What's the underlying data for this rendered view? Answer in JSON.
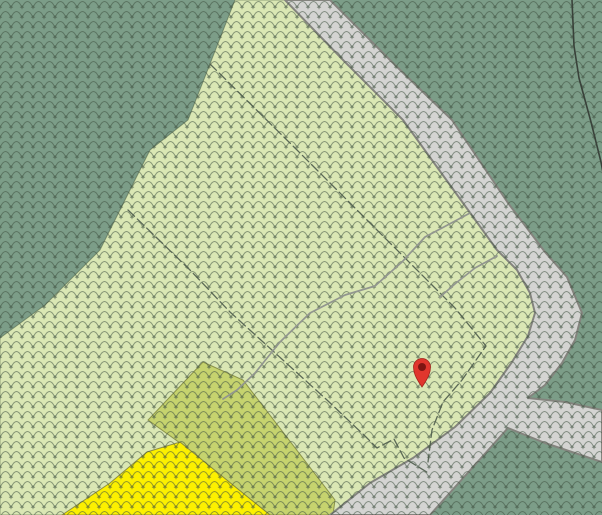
{
  "map": {
    "description": "forest-cadastral-map-with-location-marker",
    "canvas": {
      "width": 602,
      "height": 515
    },
    "colors": {
      "forest_dark_green": "#7C9D88",
      "forest_light_green": "#DAE7B4",
      "meadow_olive": "#C6D36E",
      "meadow_yellow": "#FCF000",
      "road_fill": "#D4D4D2",
      "road_casing": "#84847E",
      "parcel_line": "#4E5C4B",
      "path_line": "#92968F",
      "contour_line": "#39423A",
      "pattern_stroke": "#3F5142",
      "region_edge": "rgba(70,90,60,0.5)",
      "olive_edge": "rgba(110,115,45,0.7)",
      "yellow_edge": "rgba(120,120,60,0.8)",
      "marker_red": "#E0362D",
      "marker_dark_red": "#7E1512",
      "marker_outline": "#A3221B"
    },
    "forest_pattern": {
      "tile_width": 11,
      "tile_height": 10,
      "opacity": 0.55,
      "arc_path": "M0,7.5 Q5.5,-4.5 11,7.5",
      "tree_plus_path": "M0,5.2 L0,9.3 M-2.1,7.2 L2.1,7.2 M11,5.2 L11,9.3 M8.9,7.2 L13.1,7.2"
    },
    "regions": [
      {
        "name": "dark-forest-background",
        "kind": "rect",
        "fill_key": "forest_dark_green"
      },
      {
        "name": "light-forest-parcel",
        "kind": "polygon",
        "fill_key": "forest_light_green",
        "stroke_key": "region_edge",
        "stroke_width": 1,
        "points": [
          [
            235,
            0
          ],
          [
            287,
            0
          ],
          [
            345,
            62
          ],
          [
            403,
            120
          ],
          [
            463,
            203
          ],
          [
            497,
            250
          ],
          [
            517,
            270
          ],
          [
            530,
            293
          ],
          [
            535,
            313
          ],
          [
            528,
            336
          ],
          [
            512,
            362
          ],
          [
            490,
            393
          ],
          [
            455,
            427
          ],
          [
            413,
            458
          ],
          [
            370,
            483
          ],
          [
            330,
            515
          ],
          [
            0,
            515
          ],
          [
            0,
            338
          ],
          [
            45,
            305
          ],
          [
            100,
            250
          ],
          [
            150,
            150
          ],
          [
            188,
            120
          ],
          [
            210,
            64
          ]
        ]
      },
      {
        "name": "olive-meadow-parcel",
        "kind": "polygon",
        "fill_key": "meadow_olive",
        "stroke_key": "olive_edge",
        "stroke_width": 1,
        "points": [
          [
            203,
            362
          ],
          [
            243,
            380
          ],
          [
            335,
            500
          ],
          [
            333,
            515
          ],
          [
            270,
            515
          ],
          [
            180,
            443
          ],
          [
            148,
            420
          ]
        ]
      },
      {
        "name": "yellow-meadow-parcel",
        "kind": "polygon",
        "fill_key": "meadow_yellow",
        "stroke_key": "yellow_edge",
        "stroke_width": 1,
        "points": [
          [
            180,
            442
          ],
          [
            270,
            515
          ],
          [
            62,
            515
          ],
          [
            110,
            483
          ],
          [
            147,
            452
          ]
        ]
      }
    ],
    "road": {
      "name": "road-with-fork",
      "fill_key": "road_fill",
      "casing_key": "road_casing",
      "casing_width": 2,
      "points": [
        [
          285,
          0
        ],
        [
          330,
          0
        ],
        [
          395,
          65
        ],
        [
          452,
          120
        ],
        [
          508,
          203
        ],
        [
          545,
          252
        ],
        [
          567,
          277
        ],
        [
          582,
          313
        ],
        [
          575,
          340
        ],
        [
          562,
          363
        ],
        [
          545,
          385
        ],
        [
          528,
          398
        ],
        [
          565,
          402
        ],
        [
          602,
          410
        ],
        [
          602,
          462
        ],
        [
          545,
          443
        ],
        [
          508,
          428
        ],
        [
          430,
          515
        ],
        [
          330,
          515
        ],
        [
          370,
          483
        ],
        [
          413,
          458
        ],
        [
          455,
          427
        ],
        [
          490,
          393
        ],
        [
          512,
          362
        ],
        [
          528,
          336
        ],
        [
          535,
          313
        ],
        [
          530,
          293
        ],
        [
          517,
          270
        ],
        [
          497,
          250
        ],
        [
          463,
          203
        ],
        [
          403,
          120
        ],
        [
          345,
          62
        ]
      ]
    },
    "lines": [
      {
        "name": "parcel-boundary-a",
        "style": "parcel",
        "points": [
          [
            128,
            210
          ],
          [
            190,
            270
          ],
          [
            230,
            312
          ],
          [
            327,
            400
          ],
          [
            366,
            437
          ],
          [
            377,
            448
          ],
          [
            394,
            439
          ],
          [
            404,
            458
          ],
          [
            430,
            474
          ]
        ]
      },
      {
        "name": "parcel-boundary-b",
        "style": "parcel",
        "points": [
          [
            210,
            64
          ],
          [
            297,
            150
          ],
          [
            377,
            230
          ],
          [
            455,
            308
          ],
          [
            486,
            346
          ],
          [
            462,
            380
          ],
          [
            443,
            402
          ],
          [
            432,
            430
          ],
          [
            428,
            462
          ]
        ]
      },
      {
        "name": "footpath-a",
        "style": "path",
        "points": [
          [
            470,
            213
          ],
          [
            442,
            228
          ],
          [
            425,
            237
          ],
          [
            402,
            262
          ],
          [
            375,
            286
          ],
          [
            345,
            295
          ],
          [
            310,
            313
          ],
          [
            280,
            342
          ],
          [
            255,
            373
          ],
          [
            237,
            390
          ],
          [
            223,
            399
          ]
        ]
      },
      {
        "name": "footpath-b",
        "style": "path",
        "points": [
          [
            497,
            256
          ],
          [
            475,
            268
          ],
          [
            456,
            283
          ],
          [
            440,
            297
          ]
        ]
      },
      {
        "name": "contour-line",
        "style": "contour",
        "points": [
          [
            572,
            0
          ],
          [
            574,
            46
          ],
          [
            579,
            78
          ],
          [
            591,
            122
          ],
          [
            601,
            162
          ],
          [
            609,
            205
          ]
        ]
      }
    ],
    "line_styles": {
      "parcel": {
        "stroke_key": "parcel_line",
        "width": 1.3,
        "dash": "9 4",
        "opacity": 0.9
      },
      "path": {
        "stroke_key": "path_line",
        "width": 1.7,
        "dash": "",
        "opacity": 1
      },
      "contour": {
        "stroke_key": "contour_line",
        "width": 1.6,
        "dash": "",
        "opacity": 1
      }
    },
    "marker": {
      "name": "location-marker",
      "cx": 422,
      "cy": 367,
      "r": 8.5,
      "tip_y": 387,
      "inner_r": 4
    }
  }
}
